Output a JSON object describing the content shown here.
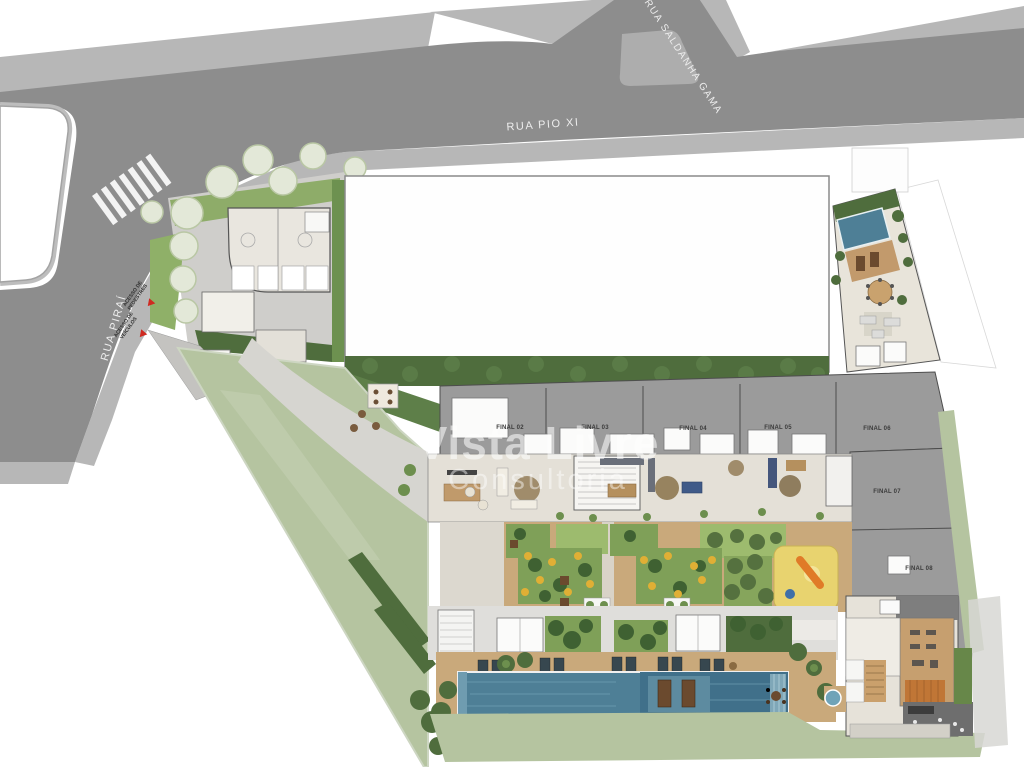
{
  "plan": {
    "type": "residential site plan / implantação",
    "streets": {
      "top": "RUA PIO XI",
      "branch": "RUA SALDANHA GAMA",
      "left": "RUA PIRAÍ"
    },
    "access": {
      "pedestrian": "ACESSO DE PEDESTRES",
      "vehicle": "ACESSO DE VEÍCULOS"
    },
    "units": [
      "FINAL 02",
      "FINAL 03",
      "FINAL 04",
      "FINAL 05",
      "FINAL 06",
      "FINAL 07",
      "FINAL 08"
    ],
    "watermark": {
      "line1": "Vista Livre",
      "line2": "Consultoria"
    }
  },
  "palette": {
    "road": "#8d8d8d",
    "sidewalk": "#b7b7b7",
    "lawn": "#b5c4a0",
    "hedge": "#4f6d3d",
    "shrub": "#6d8f4e",
    "garden": "#7fa058",
    "roof": "#9b9b9b",
    "floor": "#e4e0d7",
    "wood": "#c69f6f",
    "deck": "#c9a97b",
    "pool": "#4e7f96",
    "accent_red": "#cf2a21"
  }
}
